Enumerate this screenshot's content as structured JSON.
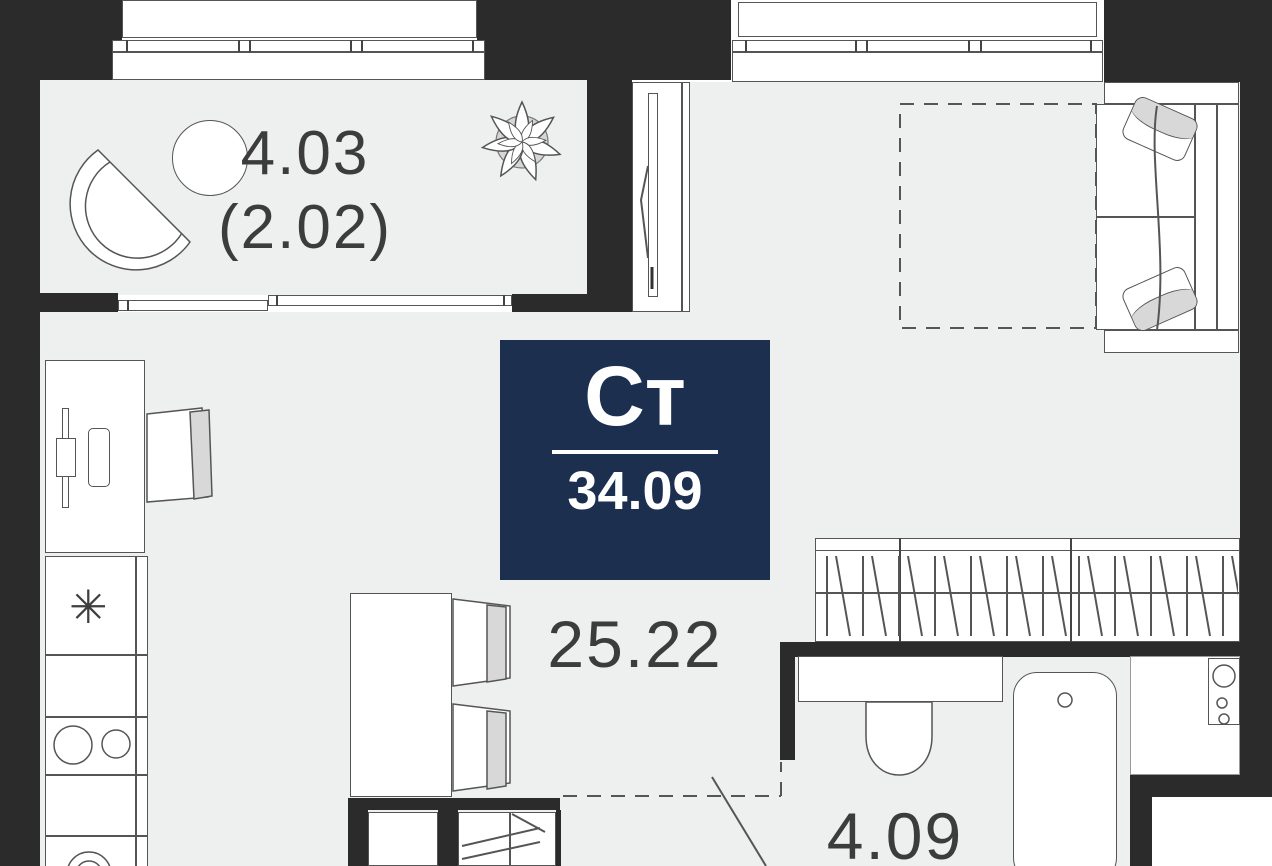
{
  "title": "Studio apartment floor plan",
  "badge": {
    "type": "Ст",
    "area": "34.09"
  },
  "labels": {
    "balcony_area": "4.03",
    "balcony_area_secondary": "(2.02)",
    "living_area": "25.22",
    "bathroom_area": "4.09"
  },
  "icons": {
    "fridge_snowflake": "✳"
  },
  "colors": {
    "wall": "#2b2b2b",
    "floor": "#edf0ee",
    "line": "#555555",
    "badge_bg": "#1c2f4f",
    "badge_text": "#ffffff",
    "fill_gray": "#d8d8d8"
  }
}
